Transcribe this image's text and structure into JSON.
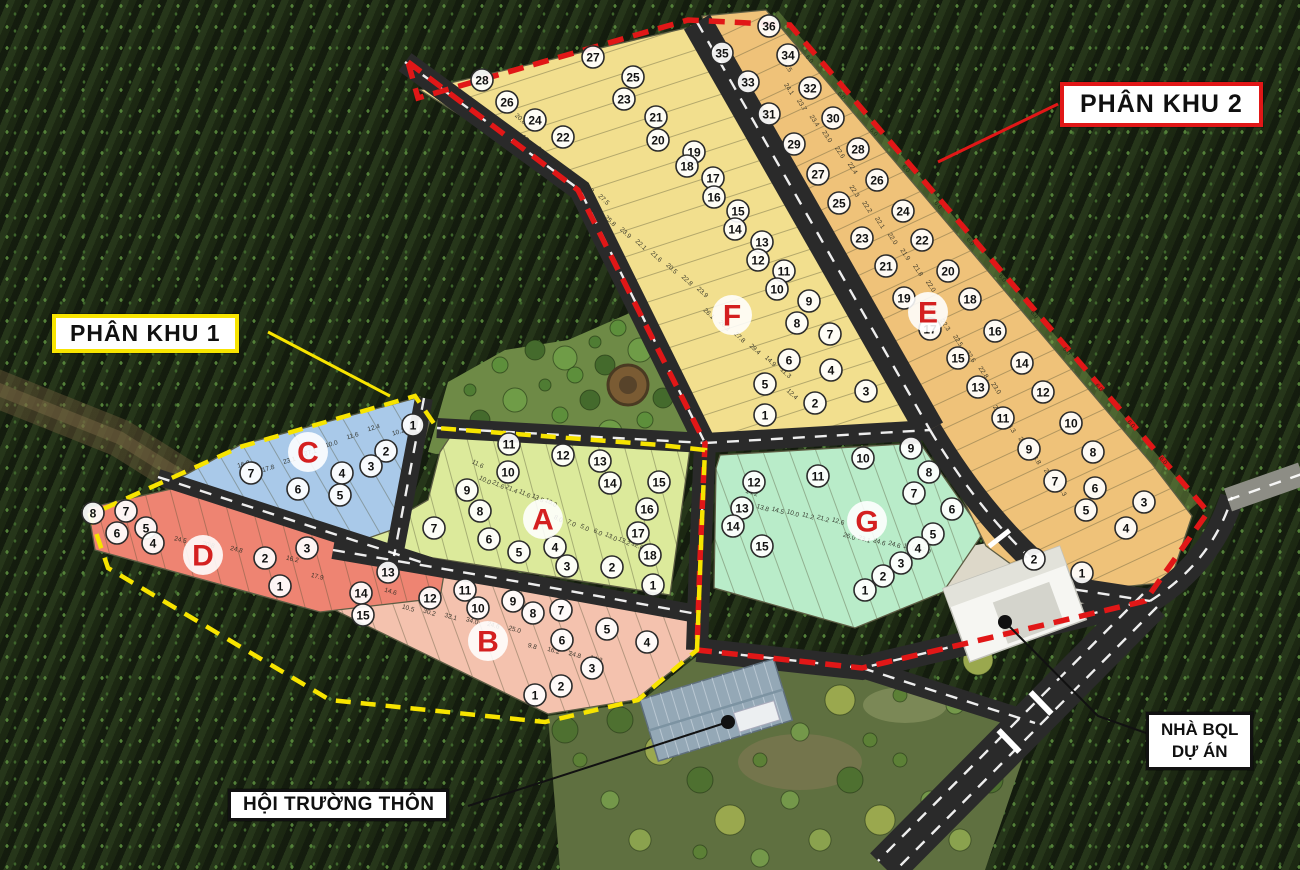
{
  "labels": {
    "phan_khu_1": "PHÂN KHU 1",
    "phan_khu_2": "PHÂN KHU 2",
    "nha_bql_line1": "NHÀ BQL",
    "nha_bql_line2": "DỰ ÁN",
    "hoi_truong_thon": "HỘI TRƯỜNG THÔN"
  },
  "colors": {
    "subzone1_boundary": "#f7e400",
    "subzone2_boundary": "#e11717",
    "zone_letter": "#d42020",
    "road": "#2a2a2a",
    "road_marking": "#ffffff",
    "existing_road": "#8d8d85",
    "forest": "#1f2b16"
  },
  "zones": [
    {
      "id": "A",
      "letter": "A",
      "fill": "#dcea9b",
      "plots": [
        11,
        12,
        13,
        10,
        14,
        15,
        9,
        16,
        8,
        17,
        7,
        6,
        5,
        4,
        18,
        3,
        2,
        1
      ],
      "dims": [
        "11.6",
        "10.0",
        "21.6",
        "21.4",
        "11.6",
        "13.5",
        "10.0",
        "8.0",
        "7.0",
        "5.0",
        "6.0",
        "13.0",
        "13.2",
        "12.0"
      ]
    },
    {
      "id": "B",
      "letter": "B",
      "fill": "#f4c2ae",
      "plots": [
        13,
        14,
        15,
        12,
        11,
        10,
        9,
        8,
        7,
        6,
        5,
        4,
        3,
        2,
        1
      ],
      "dims": [
        "14.6",
        "10.5",
        "30.2",
        "32.1",
        "34.0",
        "24.6",
        "25.0",
        "9.8",
        "16.2",
        "24.8",
        "14.3"
      ]
    },
    {
      "id": "C",
      "letter": "C",
      "fill": "#a9c9e9",
      "plots": [
        1,
        2,
        3,
        4,
        5,
        6,
        7
      ],
      "dims": [
        "16.2",
        "17.8",
        "23.1",
        "27.1",
        "10.0",
        "11.6",
        "12.4",
        "10.2"
      ]
    },
    {
      "id": "D",
      "letter": "D",
      "fill": "#ee8472",
      "plots": [
        8,
        7,
        6,
        5,
        4,
        3,
        2,
        1
      ],
      "dims": [
        "25.0",
        "25.3",
        "24.5",
        "20.8",
        "24.8",
        "14.3",
        "16.2",
        "17.9"
      ]
    },
    {
      "id": "G",
      "letter": "G",
      "fill": "#b9ecc9",
      "plots": [
        9,
        10,
        8,
        11,
        12,
        7,
        13,
        6,
        14,
        5,
        15,
        4,
        3,
        2,
        1
      ],
      "dims": [
        "14.2",
        "13.8",
        "14.5",
        "10.0",
        "11.2",
        "21.2",
        "12.6",
        "26.0",
        "23.1",
        "24.6",
        "24.6",
        "16.0",
        "12.0"
      ]
    },
    {
      "id": "F",
      "letter": "F",
      "fill": "#f2df8e",
      "plots": [
        28,
        27,
        26,
        25,
        24,
        23,
        22,
        21,
        20,
        19,
        18,
        17,
        16,
        15,
        14,
        13,
        12,
        11,
        10,
        9,
        8,
        7,
        6,
        5,
        4,
        3,
        2,
        1
      ],
      "dims": [
        "20.8",
        "17.0",
        "20.0",
        "15.0",
        "17.2",
        "15.8",
        "27.5",
        "25.8",
        "23.9",
        "22.1",
        "21.6",
        "20.5",
        "22.8",
        "23.9",
        "26.1",
        "26.3",
        "27.8",
        "29.4",
        "14.9",
        "11.3",
        "12.4"
      ]
    },
    {
      "id": "E",
      "letter": "E",
      "fill": "#efc279",
      "plots": [
        36,
        35,
        34,
        33,
        32,
        31,
        30,
        29,
        28,
        27,
        26,
        25,
        24,
        23,
        22,
        21,
        20,
        19,
        18,
        17,
        16,
        15,
        14,
        13,
        12,
        11,
        10,
        9,
        8,
        7,
        6,
        5,
        4,
        3,
        2,
        1
      ],
      "dims": [
        "24.5",
        "24.1",
        "23.7",
        "23.4",
        "23.0",
        "22.6",
        "22.4",
        "22.3",
        "22.2",
        "22.1",
        "22.0",
        "21.9",
        "21.8",
        "22.0",
        "22.1",
        "22.3",
        "22.5",
        "22.6",
        "22.8",
        "23.0",
        "23.1",
        "23.3",
        "23.6",
        "23.8",
        "24.0",
        "24.3"
      ],
      "edge_dims": [
        "6.0",
        "6.0",
        "6.0",
        "6.0",
        "6.0",
        "6.0",
        "6.0",
        "6.0",
        "6.0",
        "6.0",
        "6.0",
        "6.0"
      ]
    }
  ]
}
